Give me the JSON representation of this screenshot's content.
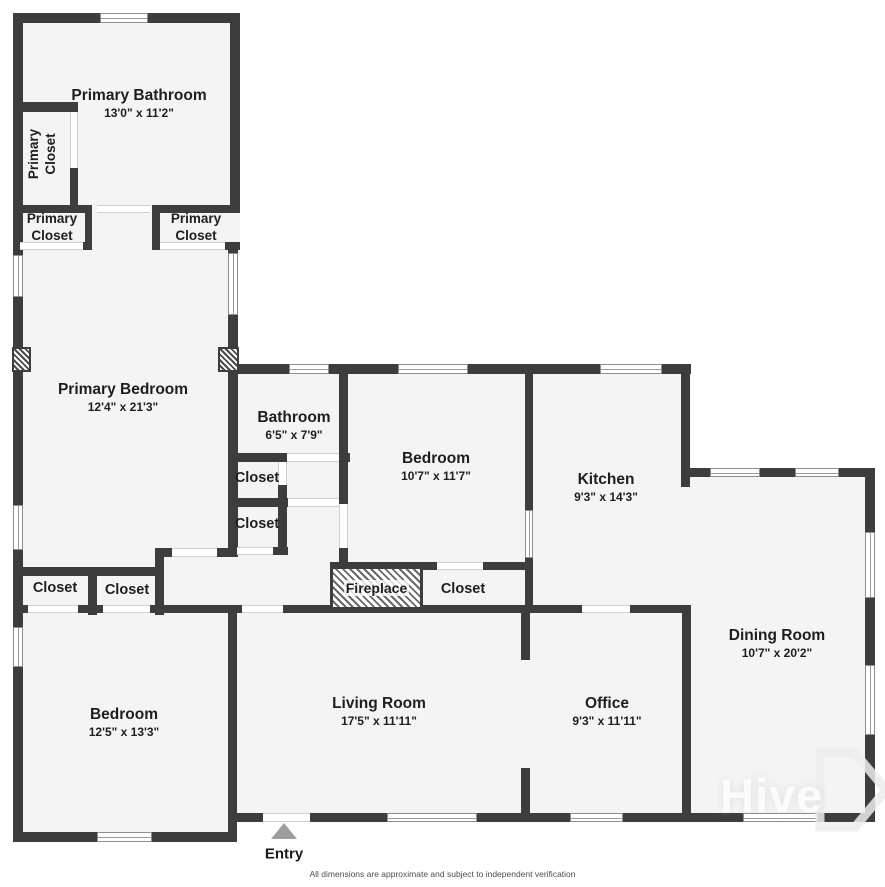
{
  "rooms": {
    "primary_bathroom": {
      "name": "Primary Bathroom",
      "dims": "13'0\" x 11'2\""
    },
    "primary_bedroom": {
      "name": "Primary Bedroom",
      "dims": "12'4\" x 21'3\""
    },
    "bathroom": {
      "name": "Bathroom",
      "dims": "6'5\" x 7'9\""
    },
    "bedroom_middle": {
      "name": "Bedroom",
      "dims": "10'7\" x 11'7\""
    },
    "kitchen": {
      "name": "Kitchen",
      "dims": "9'3\" x 14'3\""
    },
    "dining_room": {
      "name": "Dining Room",
      "dims": "10'7\" x 20'2\""
    },
    "bedroom_lower": {
      "name": "Bedroom",
      "dims": "12'5\" x 13'3\""
    },
    "living_room": {
      "name": "Living Room",
      "dims": "17'5\" x 11'11\""
    },
    "office": {
      "name": "Office",
      "dims": "9'3\" x 11'11\""
    }
  },
  "labels": {
    "primary_closet_line1": "Primary",
    "primary_closet_line2": "Closet",
    "closet": "Closet",
    "fireplace": "Fireplace",
    "entry": "Entry"
  },
  "footer": {
    "disclaimer": "All dimensions are approximate and subject to independent verification"
  },
  "watermark": {
    "text": "Hive"
  },
  "colors": {
    "wall": "#3d3d3d",
    "floor": "#f4f4f4",
    "entry_arrow": "#9e9e9e"
  }
}
